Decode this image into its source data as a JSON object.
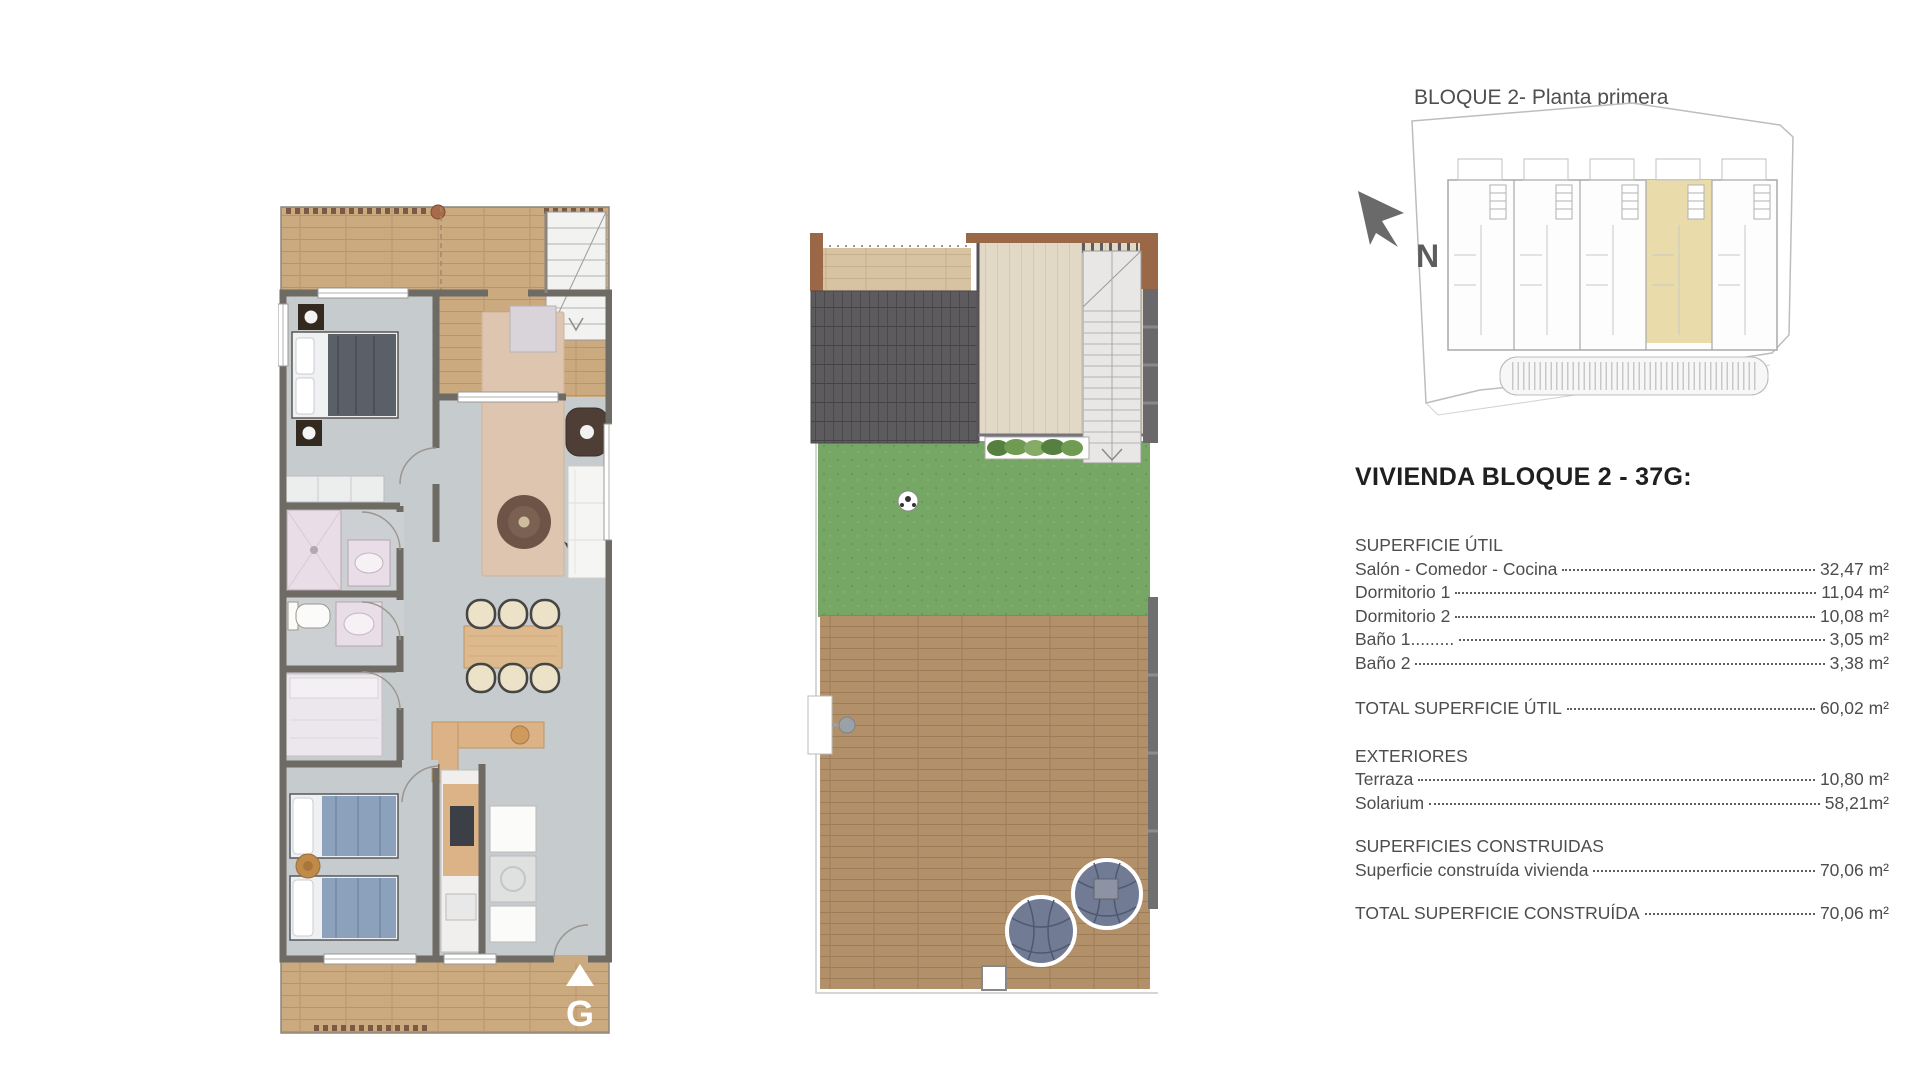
{
  "site_overview": {
    "title": "BLOQUE 2- Planta primera",
    "north_label": "N"
  },
  "apartment_plan": {
    "orientation_label": "G"
  },
  "unit_details": {
    "title": "VIVIENDA BLOQUE 2 - 37G:",
    "superficie_util": {
      "heading": "SUPERFICIE ÚTIL",
      "rows": [
        {
          "label": "Salón - Comedor - Cocina",
          "value": "32,47 m²"
        },
        {
          "label": "Dormitorio 1 ",
          "value": "11,04 m²"
        },
        {
          "label": "Dormitorio 2",
          "value": "10,08 m²"
        },
        {
          "label": "Baño 1......... ",
          "value": "3,05 m²"
        },
        {
          "label": "Baño 2 ",
          "value": "3,38 m²"
        }
      ]
    },
    "total_util": {
      "label": "TOTAL SUPERFICIE ÚTIL ",
      "value": "60,02 m²"
    },
    "exteriores": {
      "heading": "EXTERIORES",
      "rows": [
        {
          "label": "Terraza ",
          "value": "10,80 m²"
        },
        {
          "label": "Solarium",
          "value": "58,21m²"
        }
      ]
    },
    "construidas": {
      "heading": "SUPERFICIES CONSTRUIDAS",
      "rows": [
        {
          "label": "Superficie construída vivienda ",
          "value": "70,06 m²"
        }
      ]
    },
    "total_construida": {
      "label": "TOTAL SUPERFICIE CONSTRUÍDA ",
      "value": "70,06 m²"
    }
  },
  "palette": {
    "highlight_unit": "#e9dcaa",
    "grass": "#76a765",
    "roof_tiles": "#5e5b5f",
    "deck_wood": "#b2906a",
    "terrace_wood": "#cbaa7f",
    "interior_floor": "#c6cbcd",
    "wall": "#6e6a64",
    "pergola_brown": "#9b6847"
  }
}
